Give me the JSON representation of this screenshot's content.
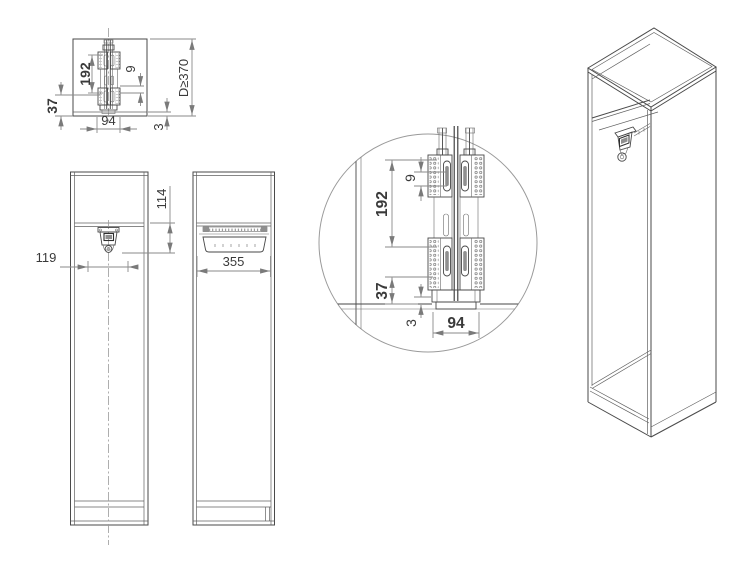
{
  "drawing": {
    "background": "#ffffff",
    "colors": {
      "object_line": "#4a4a4a",
      "dimension_line": "#8a8a8a",
      "text": "#3a3a3a",
      "detail_circle": "#9a9a9a"
    },
    "views": {
      "plan": {
        "dims": {
          "d192": "192",
          "d9": "9",
          "d37": "37",
          "d94": "94",
          "d3": "3",
          "depth": "D≥370"
        }
      },
      "front": {
        "dims": {
          "d114": "114",
          "d119": "119"
        }
      },
      "side": {
        "dims": {
          "d355": "355"
        }
      },
      "detail": {
        "dims": {
          "d9": "9",
          "d192": "192",
          "d37": "37",
          "d3": "3",
          "d94": "94"
        }
      }
    }
  }
}
